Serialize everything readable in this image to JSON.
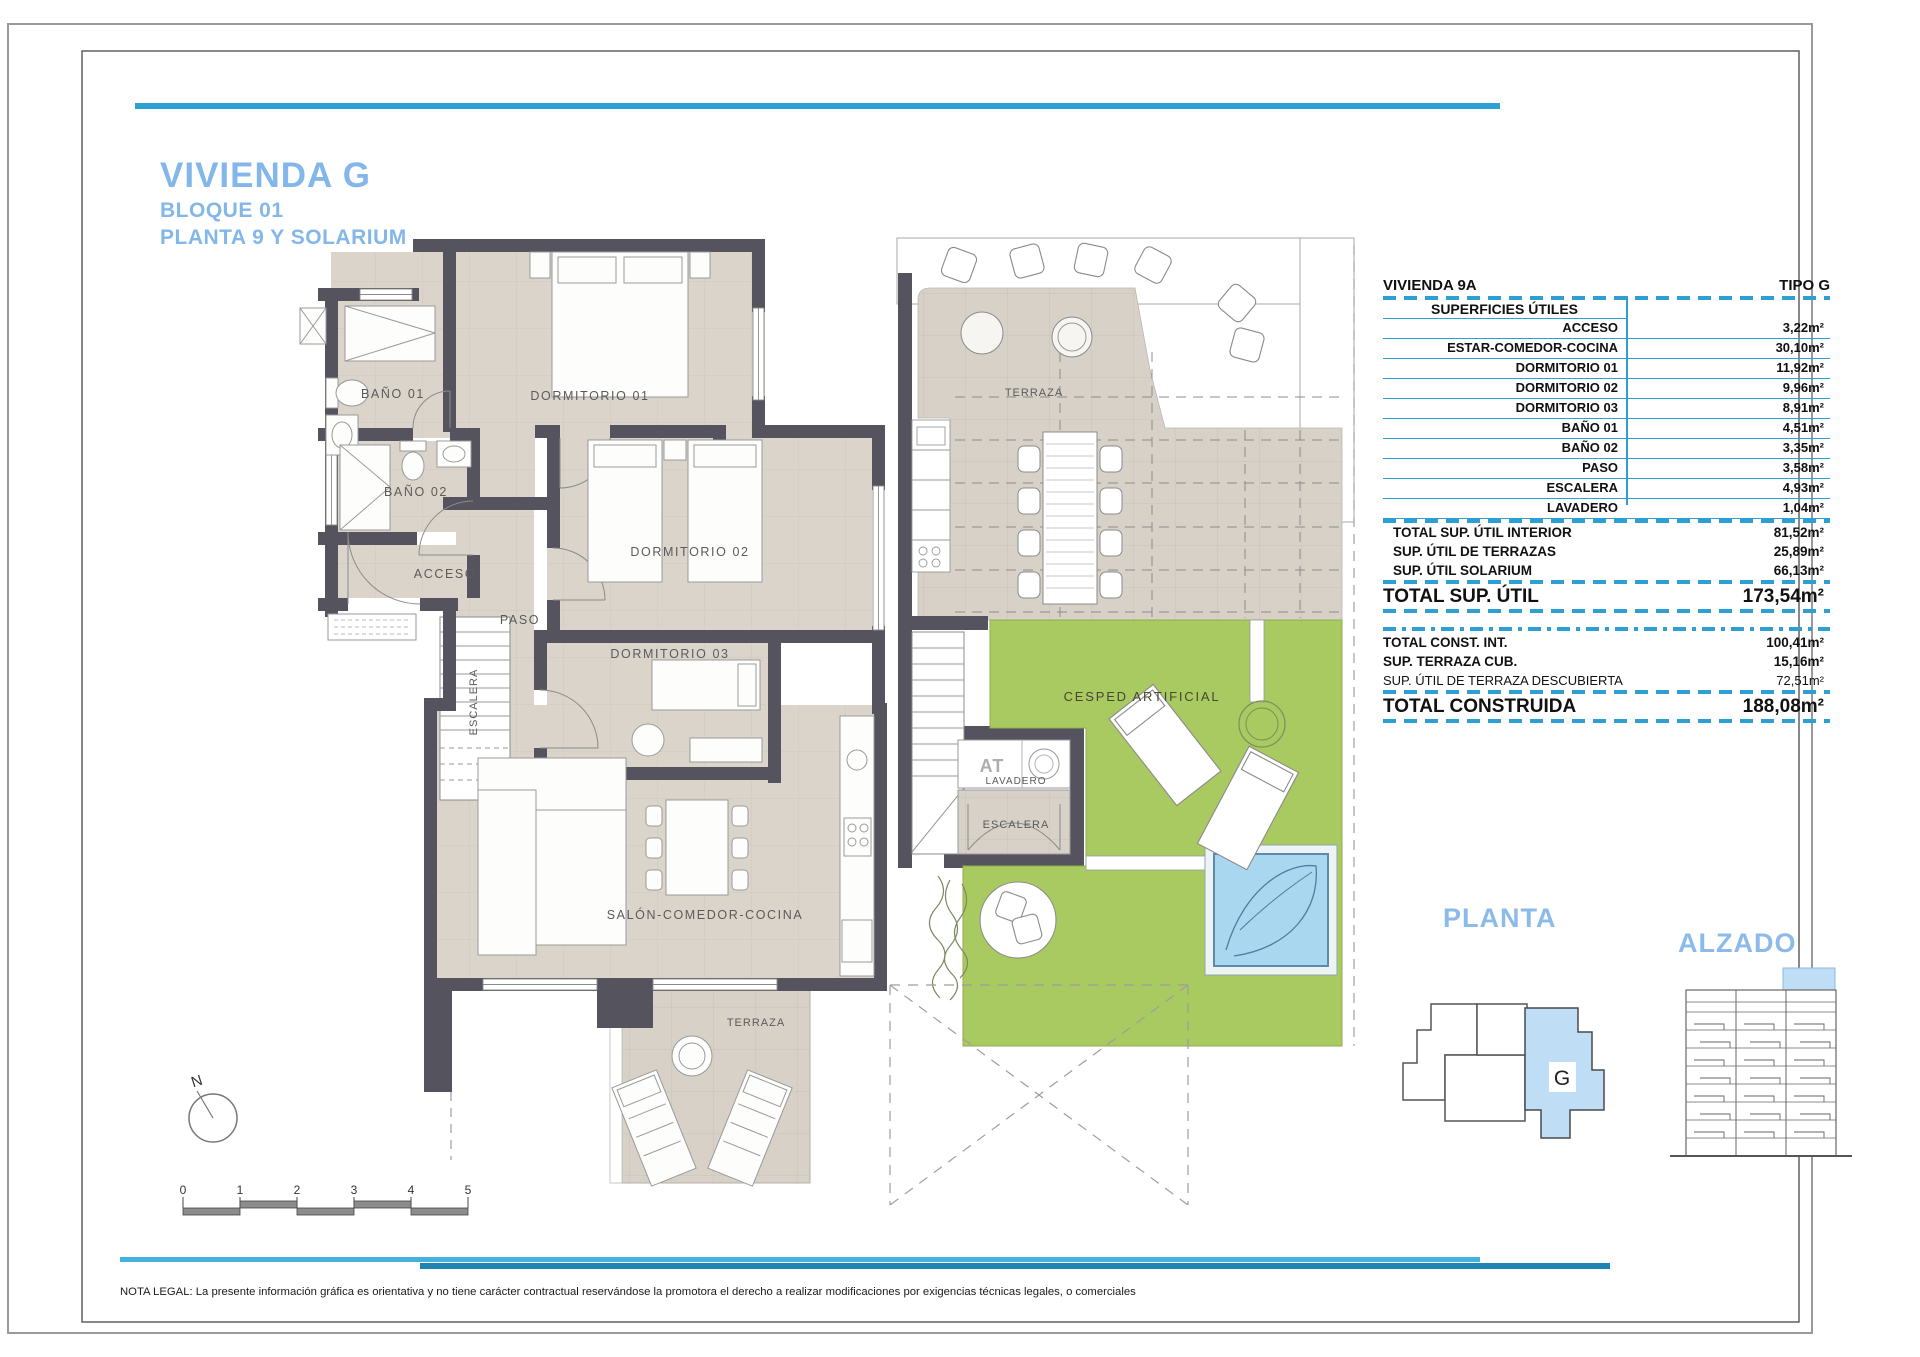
{
  "header": {
    "title": "VIVIENDA G",
    "block": "BLOQUE 01",
    "floor": "PLANTA 9 Y SOLARIUM"
  },
  "table": {
    "unit": "VIVIENDA 9A",
    "tipo": "TIPO G",
    "section": "SUPERFICIES ÚTILES",
    "rows": [
      {
        "label": "ACCESO",
        "value": "3,22m²"
      },
      {
        "label": "ESTAR-COMEDOR-COCINA",
        "value": "30,10m²"
      },
      {
        "label": "DORMITORIO 01",
        "value": "11,92m²"
      },
      {
        "label": "DORMITORIO 02",
        "value": "9,96m²"
      },
      {
        "label": "DORMITORIO 03",
        "value": "8,91m²"
      },
      {
        "label": "BAÑO 01",
        "value": "4,51m²"
      },
      {
        "label": "BAÑO 02",
        "value": "3,35m²"
      },
      {
        "label": "PASO",
        "value": "3,58m²"
      },
      {
        "label": "ESCALERA",
        "value": "4,93m²"
      },
      {
        "label": "LAVADERO",
        "value": "1,04m²"
      }
    ],
    "subtotals": [
      {
        "label": "TOTAL SUP. ÚTIL INTERIOR",
        "value": "81,52m²"
      },
      {
        "label": "SUP. ÚTIL DE TERRAZAS",
        "value": "25,89m²"
      },
      {
        "label": "SUP. ÚTIL SOLARIUM",
        "value": "66,13m²"
      }
    ],
    "total_util": {
      "label": "TOTAL SUP. ÚTIL",
      "value": "173,54m²"
    },
    "built": [
      {
        "label": "TOTAL CONST. INT.",
        "value": "100,41m²"
      },
      {
        "label": "SUP. TERRAZA CUB.",
        "value": "15,16m²"
      },
      {
        "label": "SUP. ÚTIL DE TERRAZA DESCUBIERTA",
        "value": "72,51m²"
      }
    ],
    "total_built": {
      "label": "TOTAL CONSTRUIDA",
      "value": "188,08m²"
    }
  },
  "plan": {
    "rooms": {
      "bano01": "BAÑO 01",
      "dorm01": "DORMITORIO 01",
      "bano02": "BAÑO 02",
      "dorm02": "DORMITORIO 02",
      "acceso": "ACCESO",
      "paso": "PASO",
      "dorm03": "DORMITORIO 03",
      "escalera": "ESCALERA",
      "salon": "SALÓN-COMEDOR-COCINA",
      "terraza": "TERRAZA"
    }
  },
  "solarium": {
    "terraza": "TERRAZA",
    "cesped": "CESPED ARTIFICIAL",
    "at": "AT",
    "lavadero": "LAVADERO",
    "escalera": "ESCALERA"
  },
  "keyplan": {
    "planta": "PLANTA",
    "alzado": "ALZADO",
    "unit": "G"
  },
  "compass": {
    "north": "N"
  },
  "scalebar": {
    "ticks": [
      "0",
      "1",
      "2",
      "3",
      "4",
      "5"
    ]
  },
  "legal": "NOTA LEGAL: La presente información gráfica es orientativa y no tiene carácter contractual reservándose la promotora el derecho a realizar modificaciones por exigencias técnicas legales, o comerciales"
}
